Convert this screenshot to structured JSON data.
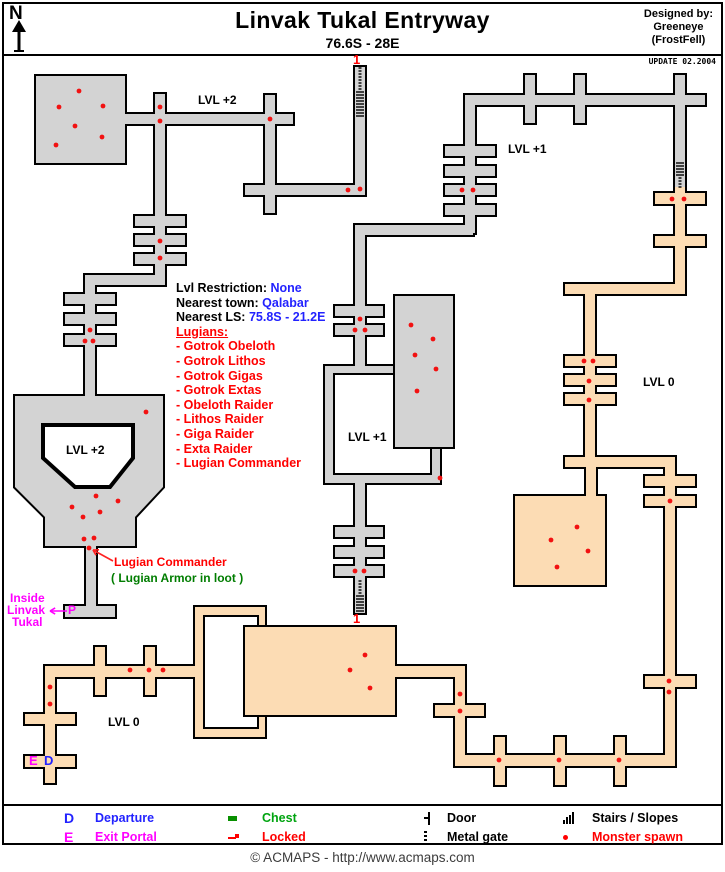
{
  "header": {
    "compass": "N",
    "title": "Linvak Tukal Entryway",
    "subtitle": "76.6S - 28E",
    "designed_by": [
      "Designed by:",
      "Greeneye",
      "(FrostFell)"
    ],
    "update_note": "UPDATE 02.2004"
  },
  "info_panel": {
    "rows": [
      {
        "label": "Lvl Restriction:",
        "value": "None"
      },
      {
        "label": "Nearest town:",
        "value": "Qalabar"
      },
      {
        "label": "Nearest LS:",
        "value": "75.8S - 21.2E"
      }
    ],
    "lugians_heading": "Lugians:",
    "lugians": [
      "- Gotrok Obeloth",
      "- Gotrok Lithos",
      "- Gotrok Gigas",
      "- Gotrok Extas",
      "- Obeloth Raider",
      "- Lithos Raider",
      "- Giga Raider",
      "- Exta Raider",
      "- Lugian Commander"
    ]
  },
  "annotations": [
    {
      "text": "LVL +2",
      "x": 198,
      "y": 94,
      "color": "#000000",
      "size": 12
    },
    {
      "text": "LVL +2",
      "x": 66,
      "y": 444,
      "color": "#000000",
      "size": 12
    },
    {
      "text": "LVL +1",
      "x": 508,
      "y": 143,
      "color": "#000000",
      "size": 12
    },
    {
      "text": "LVL +1",
      "x": 348,
      "y": 431,
      "color": "#000000",
      "size": 12
    },
    {
      "text": "LVL 0",
      "x": 643,
      "y": 376,
      "color": "#000000",
      "size": 12
    },
    {
      "text": "LVL 0",
      "x": 108,
      "y": 716,
      "color": "#000000",
      "size": 12
    },
    {
      "text": "1",
      "x": 353,
      "y": 53,
      "color": "#ff0000",
      "size": 13
    },
    {
      "text": "1",
      "x": 353,
      "y": 612,
      "color": "#ff0000",
      "size": 13
    },
    {
      "text": "P",
      "x": 68,
      "y": 604,
      "color": "#ff00ff",
      "size": 12
    },
    {
      "text": "E",
      "x": 29,
      "y": 754,
      "color": "#ff00ff",
      "size": 13
    },
    {
      "text": "D",
      "x": 44,
      "y": 754,
      "color": "#2222ff",
      "size": 13
    },
    {
      "text": "Inside",
      "x": 10,
      "y": 592,
      "color": "#ff00ff",
      "size": 12
    },
    {
      "text": "Linvak",
      "x": 7,
      "y": 604,
      "color": "#ff00ff",
      "size": 12
    },
    {
      "text": "Tukal",
      "x": 12,
      "y": 616,
      "color": "#ff00ff",
      "size": 12
    },
    {
      "text": "Lugian Commander",
      "x": 114,
      "y": 556,
      "color": "#ff0000",
      "size": 12
    },
    {
      "text": "( Lugian Armor in loot )",
      "x": 111,
      "y": 572,
      "color": "#007d00",
      "size": 12
    }
  ],
  "map": {
    "colors": {
      "gray": "#d3d3d3",
      "peach": "#fcdcb4",
      "wall": "#000000",
      "dot": "#f21111"
    },
    "shapes": [
      {
        "x": 36,
        "y": 76,
        "w": 89,
        "h": 87,
        "fill": "gray"
      },
      {
        "x": 125,
        "y": 114,
        "w": 168,
        "h": 10,
        "fill": "gray"
      },
      {
        "x": 155,
        "y": 94,
        "w": 10,
        "h": 191,
        "fill": "gray"
      },
      {
        "x": 135,
        "y": 216,
        "w": 50,
        "h": 10,
        "fill": "gray"
      },
      {
        "x": 135,
        "y": 235,
        "w": 50,
        "h": 10,
        "fill": "gray"
      },
      {
        "x": 135,
        "y": 254,
        "w": 50,
        "h": 10,
        "fill": "gray"
      },
      {
        "x": 85,
        "y": 275,
        "w": 80,
        "h": 10,
        "fill": "gray"
      },
      {
        "x": 85,
        "y": 275,
        "w": 10,
        "h": 123,
        "fill": "gray"
      },
      {
        "x": 65,
        "y": 294,
        "w": 50,
        "h": 10,
        "fill": "gray"
      },
      {
        "x": 65,
        "y": 314,
        "w": 50,
        "h": 10,
        "fill": "gray"
      },
      {
        "x": 65,
        "y": 335,
        "w": 50,
        "h": 10,
        "fill": "gray"
      },
      {
        "pts": [
          [
            15,
            396
          ],
          [
            163,
            396
          ],
          [
            163,
            487
          ],
          [
            135,
            517
          ],
          [
            135,
            546
          ],
          [
            45,
            546
          ],
          [
            45,
            517
          ],
          [
            15,
            487
          ]
        ],
        "fill": "gray"
      },
      {
        "pts": [
          [
            43,
            425
          ],
          [
            133,
            425
          ],
          [
            133,
            458
          ],
          [
            110,
            487
          ],
          [
            75,
            487
          ],
          [
            43,
            458
          ]
        ],
        "hole": true
      },
      {
        "x": 86,
        "y": 546,
        "w": 10,
        "h": 60,
        "fill": "gray"
      },
      {
        "x": 65,
        "y": 606,
        "w": 50,
        "h": 11,
        "fill": "gray"
      },
      {
        "x": 265,
        "y": 95,
        "w": 10,
        "h": 118,
        "fill": "gray"
      },
      {
        "x": 245,
        "y": 185,
        "w": 120,
        "h": 10,
        "fill": "gray"
      },
      {
        "x": 355,
        "y": 67,
        "w": 10,
        "h": 123,
        "fill": "gray"
      },
      {
        "x": 465,
        "y": 95,
        "w": 240,
        "h": 10,
        "fill": "gray"
      },
      {
        "x": 525,
        "y": 75,
        "w": 10,
        "h": 48,
        "fill": "gray"
      },
      {
        "x": 575,
        "y": 75,
        "w": 10,
        "h": 48,
        "fill": "gray"
      },
      {
        "x": 675,
        "y": 75,
        "w": 10,
        "h": 112,
        "fill": "gray"
      },
      {
        "x": 465,
        "y": 105,
        "w": 10,
        "h": 128,
        "fill": "gray"
      },
      {
        "x": 445,
        "y": 146,
        "w": 50,
        "h": 10,
        "fill": "gray"
      },
      {
        "x": 445,
        "y": 166,
        "w": 50,
        "h": 10,
        "fill": "gray"
      },
      {
        "x": 445,
        "y": 185,
        "w": 50,
        "h": 10,
        "fill": "gray"
      },
      {
        "x": 445,
        "y": 205,
        "w": 50,
        "h": 10,
        "fill": "gray"
      },
      {
        "x": 357,
        "y": 225,
        "w": 116,
        "h": 10,
        "fill": "gray"
      },
      {
        "x": 355,
        "y": 225,
        "w": 10,
        "h": 142,
        "fill": "gray"
      },
      {
        "x": 335,
        "y": 306,
        "w": 48,
        "h": 10,
        "fill": "gray"
      },
      {
        "x": 335,
        "y": 325,
        "w": 48,
        "h": 10,
        "fill": "gray"
      },
      {
        "x": 325,
        "y": 366,
        "w": 115,
        "h": 117,
        "fill": "gray"
      },
      {
        "x": 335,
        "y": 375,
        "w": 95,
        "h": 98,
        "hole": true
      },
      {
        "x": 395,
        "y": 296,
        "w": 58,
        "h": 151,
        "fill": "gray",
        "own": true
      },
      {
        "x": 355,
        "y": 483,
        "w": 10,
        "h": 130,
        "fill": "gray"
      },
      {
        "x": 335,
        "y": 527,
        "w": 48,
        "h": 10,
        "fill": "gray"
      },
      {
        "x": 335,
        "y": 547,
        "w": 48,
        "h": 10,
        "fill": "gray"
      },
      {
        "x": 335,
        "y": 566,
        "w": 48,
        "h": 10,
        "fill": "gray"
      },
      {
        "x": 675,
        "y": 187,
        "w": 10,
        "h": 107,
        "fill": "peach"
      },
      {
        "x": 655,
        "y": 193,
        "w": 50,
        "h": 11,
        "fill": "peach"
      },
      {
        "x": 655,
        "y": 236,
        "w": 50,
        "h": 10,
        "fill": "peach"
      },
      {
        "x": 565,
        "y": 284,
        "w": 120,
        "h": 10,
        "fill": "peach"
      },
      {
        "x": 585,
        "y": 294,
        "w": 10,
        "h": 163,
        "fill": "peach"
      },
      {
        "x": 565,
        "y": 356,
        "w": 50,
        "h": 10,
        "fill": "peach"
      },
      {
        "x": 565,
        "y": 375,
        "w": 50,
        "h": 10,
        "fill": "peach"
      },
      {
        "x": 565,
        "y": 394,
        "w": 50,
        "h": 10,
        "fill": "peach"
      },
      {
        "x": 565,
        "y": 457,
        "w": 110,
        "h": 10,
        "fill": "peach"
      },
      {
        "x": 586,
        "y": 467,
        "w": 10,
        "h": 29,
        "fill": "peach"
      },
      {
        "x": 515,
        "y": 496,
        "w": 90,
        "h": 89,
        "fill": "peach"
      },
      {
        "x": 665,
        "y": 467,
        "w": 10,
        "h": 299,
        "fill": "peach"
      },
      {
        "x": 645,
        "y": 476,
        "w": 50,
        "h": 10,
        "fill": "peach"
      },
      {
        "x": 645,
        "y": 496,
        "w": 50,
        "h": 10,
        "fill": "peach"
      },
      {
        "x": 645,
        "y": 676,
        "w": 50,
        "h": 11,
        "fill": "peach"
      },
      {
        "x": 455,
        "y": 755,
        "w": 220,
        "h": 11,
        "fill": "peach"
      },
      {
        "x": 495,
        "y": 737,
        "w": 10,
        "h": 48,
        "fill": "peach"
      },
      {
        "x": 555,
        "y": 737,
        "w": 10,
        "h": 48,
        "fill": "peach"
      },
      {
        "x": 615,
        "y": 737,
        "w": 10,
        "h": 48,
        "fill": "peach"
      },
      {
        "x": 455,
        "y": 667,
        "w": 10,
        "h": 99,
        "fill": "peach"
      },
      {
        "x": 435,
        "y": 705,
        "w": 49,
        "h": 11,
        "fill": "peach"
      },
      {
        "x": 195,
        "y": 607,
        "w": 70,
        "h": 130,
        "fill": "peach"
      },
      {
        "x": 205,
        "y": 617,
        "w": 52,
        "h": 110,
        "hole": true
      },
      {
        "x": 245,
        "y": 627,
        "w": 150,
        "h": 88,
        "fill": "peach",
        "own": true
      },
      {
        "x": 395,
        "y": 666,
        "w": 70,
        "h": 11,
        "fill": "peach"
      },
      {
        "x": 45,
        "y": 666,
        "w": 150,
        "h": 11,
        "fill": "peach"
      },
      {
        "x": 45,
        "y": 666,
        "w": 10,
        "h": 117,
        "fill": "peach"
      },
      {
        "x": 95,
        "y": 647,
        "w": 10,
        "h": 48,
        "fill": "peach"
      },
      {
        "x": 145,
        "y": 647,
        "w": 10,
        "h": 48,
        "fill": "peach"
      },
      {
        "x": 25,
        "y": 714,
        "w": 50,
        "h": 10,
        "fill": "peach"
      },
      {
        "x": 25,
        "y": 756,
        "w": 50,
        "h": 11,
        "fill": "peach"
      }
    ],
    "stairs": [
      {
        "x": 355,
        "y": 68,
        "w": 10,
        "h": 50,
        "dots": "top"
      },
      {
        "x": 675,
        "y": 163,
        "w": 10,
        "h": 24,
        "dots": "bottom"
      },
      {
        "x": 355,
        "y": 581,
        "w": 10,
        "h": 32,
        "dots": "top"
      }
    ],
    "dots": [
      [
        79,
        91
      ],
      [
        59,
        107
      ],
      [
        103,
        106
      ],
      [
        75,
        126
      ],
      [
        102,
        137
      ],
      [
        56,
        145
      ],
      [
        160,
        107
      ],
      [
        160,
        121
      ],
      [
        270,
        119
      ],
      [
        348,
        190
      ],
      [
        360,
        189
      ],
      [
        160,
        241
      ],
      [
        160,
        258
      ],
      [
        90,
        330
      ],
      [
        85,
        341
      ],
      [
        93,
        341
      ],
      [
        146,
        412
      ],
      [
        96,
        496
      ],
      [
        118,
        501
      ],
      [
        72,
        507
      ],
      [
        100,
        512
      ],
      [
        83,
        517
      ],
      [
        84,
        539
      ],
      [
        94,
        538
      ],
      [
        89,
        548
      ],
      [
        462,
        190
      ],
      [
        473,
        190
      ],
      [
        360,
        319
      ],
      [
        355,
        330
      ],
      [
        365,
        330
      ],
      [
        411,
        325
      ],
      [
        433,
        339
      ],
      [
        415,
        355
      ],
      [
        436,
        369
      ],
      [
        417,
        391
      ],
      [
        440,
        478
      ],
      [
        355,
        571
      ],
      [
        364,
        571
      ],
      [
        672,
        199
      ],
      [
        684,
        199
      ],
      [
        584,
        361
      ],
      [
        593,
        361
      ],
      [
        589,
        381
      ],
      [
        589,
        400
      ],
      [
        670,
        501
      ],
      [
        669,
        681
      ],
      [
        669,
        692
      ],
      [
        577,
        527
      ],
      [
        551,
        540
      ],
      [
        588,
        551
      ],
      [
        557,
        567
      ],
      [
        365,
        655
      ],
      [
        350,
        670
      ],
      [
        370,
        688
      ],
      [
        499,
        760
      ],
      [
        559,
        760
      ],
      [
        619,
        760
      ],
      [
        460,
        694
      ],
      [
        460,
        711
      ],
      [
        130,
        670
      ],
      [
        149,
        670
      ],
      [
        163,
        670
      ],
      [
        50,
        687
      ],
      [
        50,
        704
      ]
    ],
    "arrows": [
      {
        "x1": 67,
        "y1": 611,
        "x2": 50,
        "y2": 611,
        "color": "#ff00ff"
      },
      {
        "x1": 113,
        "y1": 561,
        "x2": 93,
        "y2": 550,
        "color": "#ff2222"
      }
    ]
  },
  "legend": {
    "items": [
      {
        "key": "departure",
        "type": "letter",
        "symbol": "D",
        "color": "#2222ff",
        "label": "Departure",
        "label_color": "#2222ff"
      },
      {
        "key": "exit-portal",
        "type": "letter",
        "symbol": "E",
        "color": "#ff00ff",
        "label": "Exit Portal",
        "label_color": "#ff00ff"
      },
      {
        "key": "chest",
        "type": "chest",
        "color": "#089000",
        "label": "Chest",
        "label_color": "#00a410"
      },
      {
        "key": "locked",
        "type": "locked",
        "color": "#ff0000",
        "label": "Locked",
        "label_color": "#ff0000"
      },
      {
        "key": "door",
        "type": "door",
        "color": "#000000",
        "label": "Door",
        "label_color": "#000000"
      },
      {
        "key": "metal-gate",
        "type": "gate",
        "color": "#000000",
        "label": "Metal gate",
        "label_color": "#000000"
      },
      {
        "key": "stairs-slopes",
        "type": "stairs",
        "color": "#000000",
        "label": "Stairs / Slopes",
        "label_color": "#000000"
      },
      {
        "key": "monster-spawn",
        "type": "monster",
        "color": "#ff0000",
        "label": "Monster spawn",
        "label_color": "#ff0000"
      }
    ]
  },
  "footer": {
    "copyright": "© ACMAPS - http://www.acmaps.com"
  }
}
